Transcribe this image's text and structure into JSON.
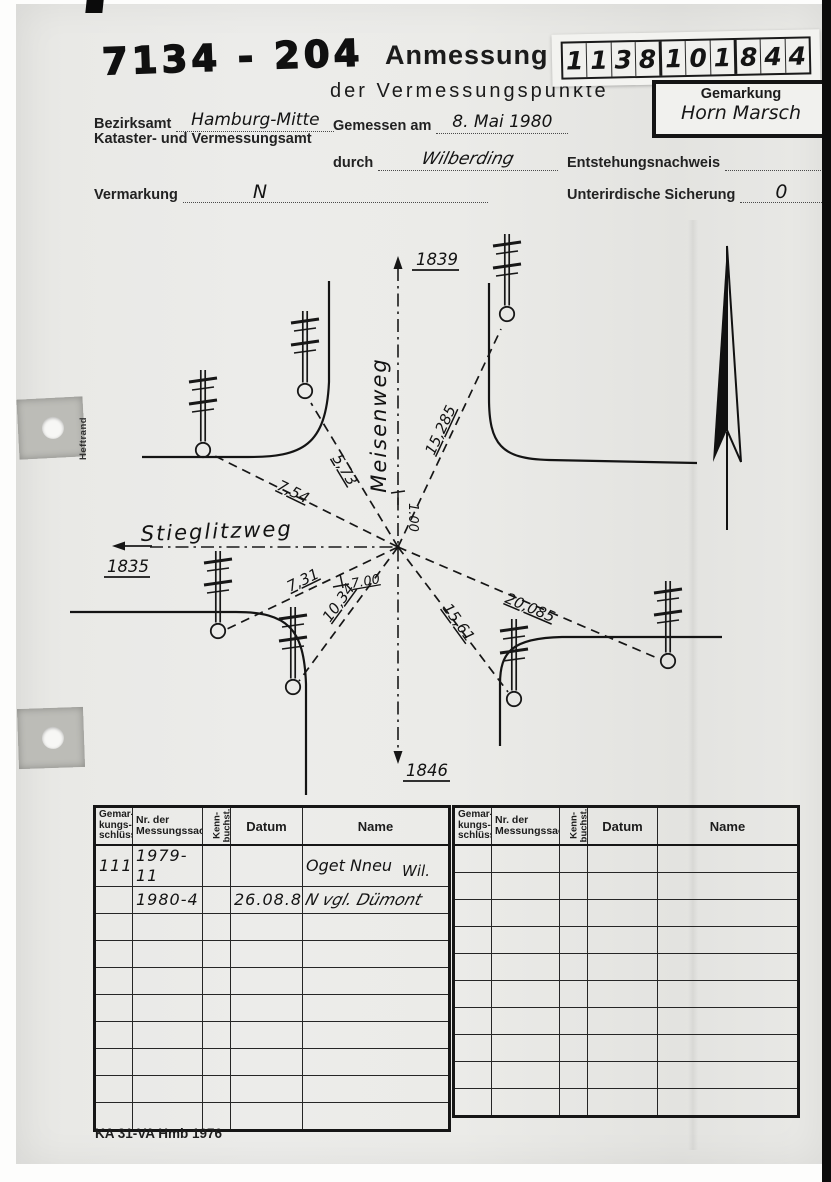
{
  "page": {
    "doc_number": "7134 - 204",
    "title": "Anmessung",
    "subtitle": "der Vermessungspunkte",
    "footer": "KA 31-VA Hmb 1976",
    "margin_note": "Heftrand"
  },
  "stamp": {
    "digits": [
      "1",
      "1",
      "3",
      "8",
      "1",
      "0",
      "1",
      "8",
      "4",
      "4"
    ]
  },
  "gemarkung": {
    "label": "Gemarkung",
    "value": "Horn Marsch"
  },
  "form": {
    "bezirksamt": {
      "label": "Bezirksamt",
      "value": "Hamburg-Mitte"
    },
    "amt_line2": "Kataster- und Vermessungsamt",
    "gemessen_am": {
      "label": "Gemessen am",
      "value": "8. Mai 1980"
    },
    "durch": {
      "label": "durch",
      "value": "Wilberding"
    },
    "entstehungsnachweis": {
      "label": "Entstehungsnachweis",
      "value": ""
    },
    "vermarkung": {
      "label": "Vermarkung",
      "value": "N"
    },
    "unterirdische_sicherung": {
      "label": "Unterirdische Sicherung",
      "value": "0"
    }
  },
  "sketch": {
    "street_vertical": "Meisenweg",
    "street_horizontal": "Stieglitzweg",
    "point_top": "1839",
    "point_left": "1835",
    "point_bottom": "1846",
    "measurements": [
      {
        "value": "7,54"
      },
      {
        "value": "5,73"
      },
      {
        "value": "15,285"
      },
      {
        "value": "7,31"
      },
      {
        "value": "10,34"
      },
      {
        "value": "15,61"
      },
      {
        "value": "20,085"
      }
    ],
    "offsets": [
      {
        "value": "1.00"
      },
      {
        "value": "7.00"
      }
    ]
  },
  "tables": {
    "headers": {
      "col1": "Gemar-\nkungs-\nschlüssel",
      "col2": "Nr. der\nMessungssache",
      "col3": "Kenn-\nbuchst.",
      "col4": "Datum",
      "col5": "Name"
    },
    "left_rows": [
      {
        "c": [
          "111",
          "1979-11",
          "",
          "",
          "Oget Nneu"
        ],
        "extra": "Wil."
      },
      {
        "c": [
          "",
          "1980-4",
          "",
          "26.08.80",
          "N vgl. Dümont"
        ]
      },
      {
        "c": [
          "",
          "",
          "",
          "",
          ""
        ]
      },
      {
        "c": [
          "",
          "",
          "",
          "",
          ""
        ]
      },
      {
        "c": [
          "",
          "",
          "",
          "",
          ""
        ]
      },
      {
        "c": [
          "",
          "",
          "",
          "",
          ""
        ]
      },
      {
        "c": [
          "",
          "",
          "",
          "",
          ""
        ]
      },
      {
        "c": [
          "",
          "",
          "",
          "",
          ""
        ]
      },
      {
        "c": [
          "",
          "",
          "",
          "",
          ""
        ]
      },
      {
        "c": [
          "",
          "",
          "",
          "",
          ""
        ]
      }
    ],
    "right_rows": [
      {
        "c": [
          "",
          "",
          "",
          "",
          ""
        ]
      },
      {
        "c": [
          "",
          "",
          "",
          "",
          ""
        ]
      },
      {
        "c": [
          "",
          "",
          "",
          "",
          ""
        ]
      },
      {
        "c": [
          "",
          "",
          "",
          "",
          ""
        ]
      },
      {
        "c": [
          "",
          "",
          "",
          "",
          ""
        ]
      },
      {
        "c": [
          "",
          "",
          "",
          "",
          ""
        ]
      },
      {
        "c": [
          "",
          "",
          "",
          "",
          ""
        ]
      },
      {
        "c": [
          "",
          "",
          "",
          "",
          ""
        ]
      },
      {
        "c": [
          "",
          "",
          "",
          "",
          ""
        ]
      },
      {
        "c": [
          "",
          "",
          "",
          "",
          ""
        ]
      }
    ]
  }
}
